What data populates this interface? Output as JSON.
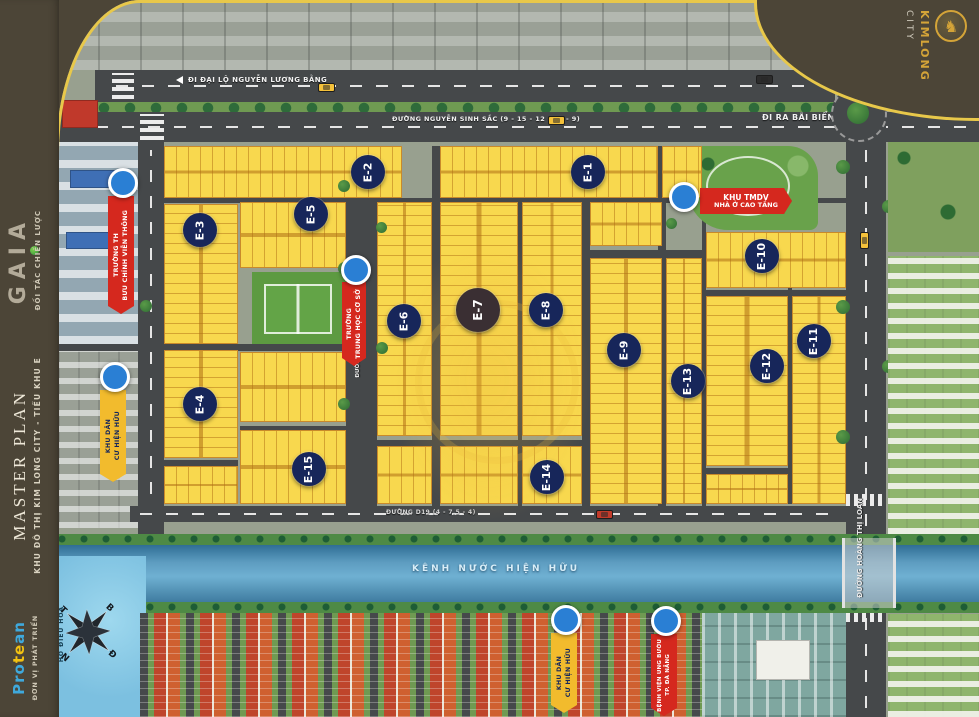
{
  "sidebar": {
    "partner_label": "ĐỐI TÁC CHIẾN LƯỢC",
    "partner_logo": "GAIA",
    "title": "MASTER PLAN",
    "subtitle": "KHU ĐÔ THỊ KIM LONG CITY - TIỂU KHU E",
    "developer_label": "ĐƠN VỊ PHÁT TRIỂN",
    "developer_logo_pro": "Pro",
    "developer_logo_te": "te",
    "developer_logo_an": "an"
  },
  "brand": {
    "name": "KIMLONG",
    "suffix": "CITY",
    "emblem_glyph": "♞"
  },
  "roads": {
    "top_avenue": "ĐI ĐẠI LỘ NGUYỄN LƯƠNG BẰNG",
    "main_road": "ĐƯỜNG NGUYỄN SINH SẮC (9 - 15 - 12 - 15 - 9)",
    "to_beach": "ĐI RA BÃI BIỂN",
    "right_road": "ĐƯỜNG HOÀNG THỊ LOAN",
    "d19": "ĐƯỜNG D19 (4 - 7.5 - 4)",
    "d15": "ĐƯỜNG D15 (3 - 10.5 - 3)",
    "d9": "ĐƯỜNG D9 (3 - 7.5 - 3)"
  },
  "water": {
    "canal_label": "KÊNH NƯỚC HIỆN HỮU",
    "lake_label": "HỒ ĐIỀU HOÀ"
  },
  "compass": {
    "north": "B",
    "south": "N",
    "east": "Đ",
    "west": "T"
  },
  "landmarks": {
    "post_school": {
      "line1": "TRƯỜNG TH",
      "line2": "BƯU CHÍNH VIỄN THÔNG"
    },
    "secondary_school": {
      "line1": "TRƯỜNG",
      "line2": "TRUNG HỌC CƠ SỞ"
    },
    "commercial": {
      "line1": "KHU TMDV",
      "line2": "NHÀ Ở CAO TẦNG"
    },
    "residential_left": {
      "line1": "KHU DÂN",
      "line2": "CƯ HIỆN HỮU"
    },
    "residential_bottom": {
      "line1": "KHU DÂN",
      "line2": "CƯ HIỆN HỮU"
    },
    "hospital": {
      "line1": "BỆNH VIỆN UNG BƯỚU",
      "line2": "TP. ĐÀ NẴNG"
    }
  },
  "blocks": {
    "e1": "E-1",
    "e2": "E-2",
    "e3": "E-3",
    "e4": "E-4",
    "e5": "E-5",
    "e6": "E-6",
    "e7": "E-7",
    "e8": "E-8",
    "e9": "E-9",
    "e10": "E-10",
    "e11": "E-11",
    "e12": "E-12",
    "e13": "E-13",
    "e14": "E-14",
    "e15": "E-15"
  },
  "colors": {
    "accent_gold": "#e8c84a",
    "lot_yellow": "#f8d84e",
    "block_navy": "#17265a",
    "banner_red": "#d5281e",
    "banner_yellow": "#f2bb2d",
    "canal_blue": "#5d9cc0"
  }
}
